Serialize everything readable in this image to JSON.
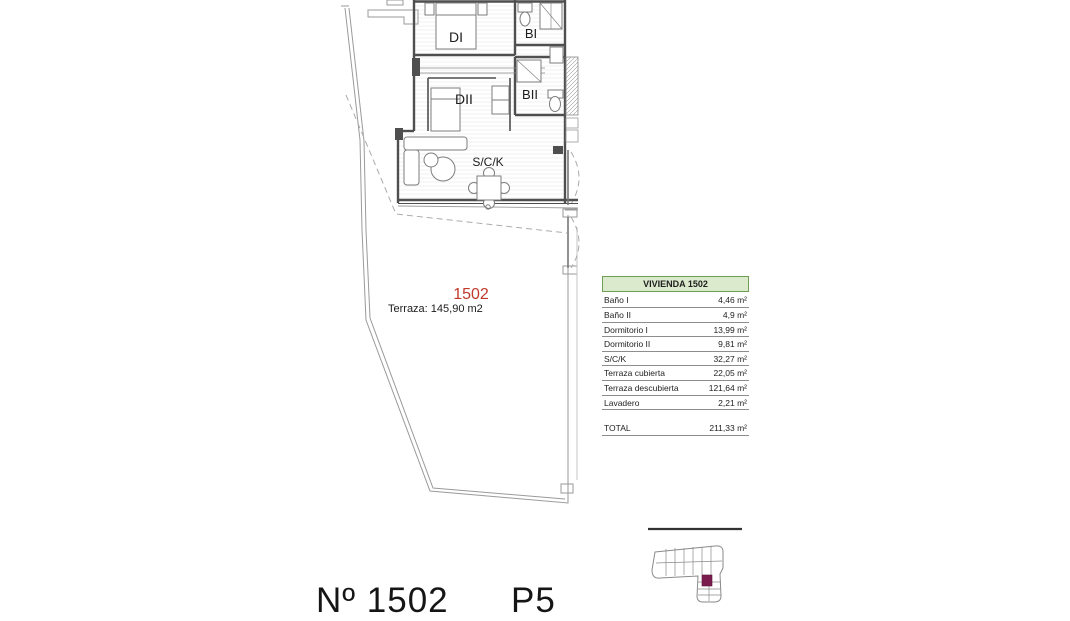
{
  "plan": {
    "unit_number": "1502",
    "terrace_label": "Terraza: 145,90 m2",
    "rooms": {
      "di": "DI",
      "bi": "BI",
      "dii": "DII",
      "bii": "BII",
      "sck": "S/C/K"
    }
  },
  "area_table": {
    "header": "VIVIENDA 1502",
    "rows": [
      {
        "label": "Baño I",
        "value": "4,46 m²"
      },
      {
        "label": "Baño II",
        "value": "4,9 m²"
      },
      {
        "label": "Dormitorio I",
        "value": "13,99 m²"
      },
      {
        "label": "Dormitorio II",
        "value": "9,81 m²"
      },
      {
        "label": "S/C/K",
        "value": "32,27 m²"
      },
      {
        "label": "Terraza cubierta",
        "value": "22,05 m²"
      },
      {
        "label": "Terraza descubierta",
        "value": "121,64 m²"
      },
      {
        "label": "Lavadero",
        "value": "2,21 m²"
      }
    ],
    "total": {
      "label": "TOTAL",
      "value": "211,33 m²"
    }
  },
  "footer": {
    "unit": "Nº 1502",
    "floor": "P5"
  },
  "colors": {
    "unit_red": "#c0392b",
    "table_green": "#dbe9cd",
    "table_green_border": "#6d9e53",
    "keyplan_highlight": "#7a1d4e"
  }
}
